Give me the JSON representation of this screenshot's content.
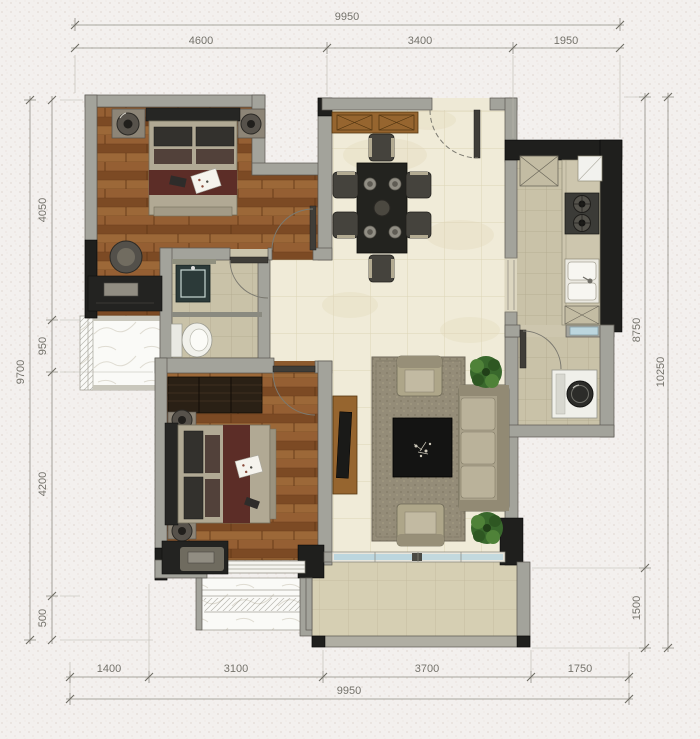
{
  "dims": {
    "top": {
      "overall": "9950",
      "segments": [
        "4600",
        "3400",
        "1950"
      ]
    },
    "bottom": {
      "overall": "9950",
      "segments": [
        "1400",
        "3100",
        "3700",
        "1750"
      ]
    },
    "left": {
      "overall": "9700",
      "segments": [
        "4050",
        "950",
        "4200",
        "500"
      ]
    },
    "right": {
      "overall": "10250",
      "segments": [
        "8750",
        "1500"
      ]
    }
  },
  "palette": {
    "paper": "#f3f0ee",
    "wall_gray": "#a3a39b",
    "wall_dark": "#1f1f1d",
    "wood_floor": "#8c5a2e",
    "tile_cream": "#f0ebd8",
    "tile_beige": "#c9c2a8",
    "balcony_tile": "#d6cfb3",
    "bed_runner_red": "#5c2d27",
    "plant_green": "#39682c",
    "window_blue": "#bcd6de",
    "dim_text": "#74726b"
  }
}
